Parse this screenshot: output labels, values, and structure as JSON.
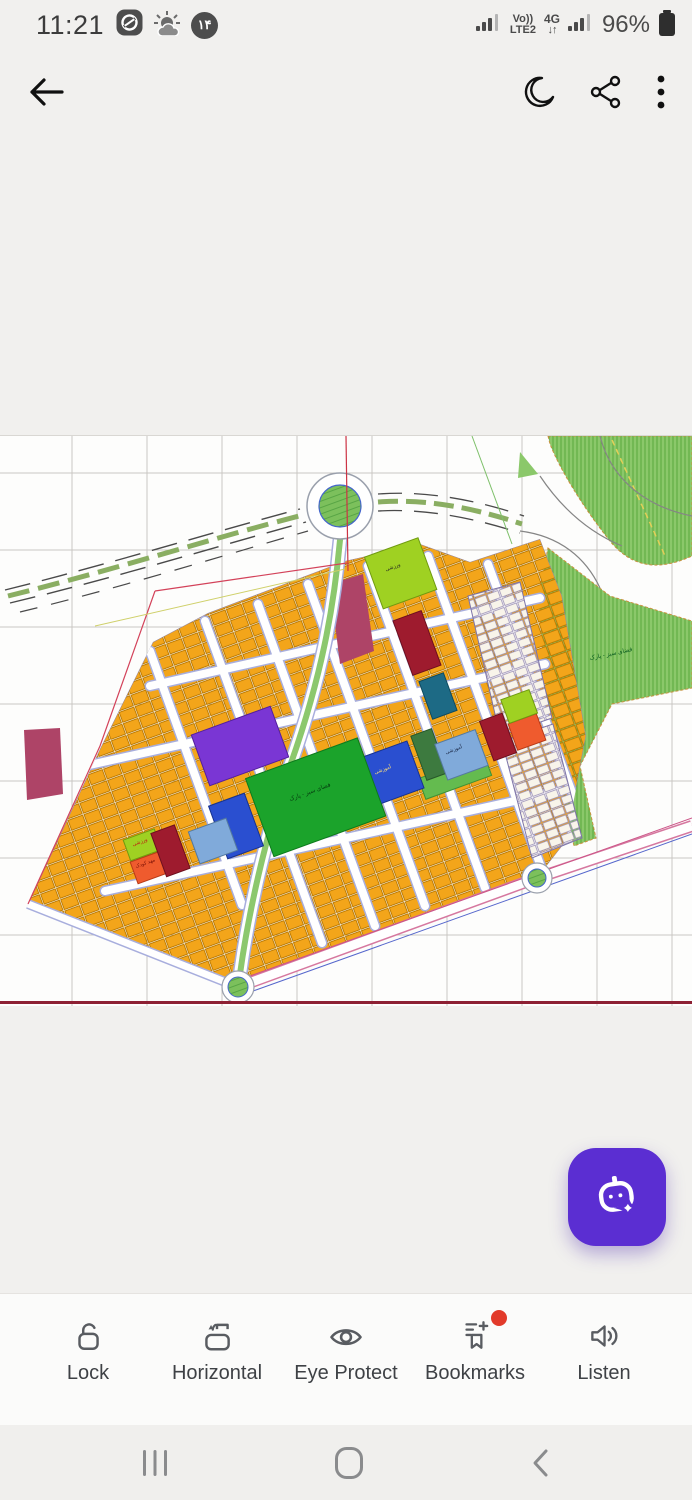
{
  "status_bar": {
    "time": "11:21",
    "notification_icons": [
      "eitaa-app-icon",
      "weather-sun-cloud-icon",
      "calendar-day-14-badge"
    ],
    "calendar_badge_text": "۱۴",
    "network_line1": "Vo))",
    "network_line2": "LTE2",
    "network_type": "4G",
    "network_arrows": "↓↑",
    "battery_percent": "96%"
  },
  "toolbar": {
    "back": "back",
    "night_mode": "night-mode",
    "share": "share",
    "more": "more-options"
  },
  "map": {
    "description": "urban zoning plan drawing",
    "labels": {
      "park_center": "فضای سبز - پارک",
      "park_right": "فضای سبز - پارک",
      "sports_1": "ورزشی",
      "sports_2": "ورزشی",
      "kindergarten": "مهد کودک",
      "school_1": "آموزشی",
      "school_2": "آموزشی"
    },
    "colors": {
      "residential_plot": "#f3a51a",
      "green_space": "#8bc86a",
      "park": "#1ba32b",
      "education_blue": "#2a4fd0",
      "culture_purple": "#7a36d4",
      "commercial_red": "#9e1b2e",
      "kindergarten_orange": "#ef5b2e",
      "sports_lime": "#9fd122",
      "boundary_red": "#d3425a"
    }
  },
  "fab": {
    "name": "ai-assistant",
    "color": "#5b2ed2"
  },
  "bottom_toolbar": {
    "items": [
      {
        "label": "Lock",
        "icon": "unlock-icon"
      },
      {
        "label": "Horizontal",
        "icon": "rotate-horizontal-icon"
      },
      {
        "label": "Eye Protect",
        "icon": "eye-icon"
      },
      {
        "label": "Bookmarks",
        "icon": "bookmarks-add-icon",
        "badge": true
      },
      {
        "label": "Listen",
        "icon": "speaker-icon"
      }
    ]
  },
  "nav_bar": {
    "recents": "recent-apps",
    "home": "home",
    "back": "back"
  }
}
